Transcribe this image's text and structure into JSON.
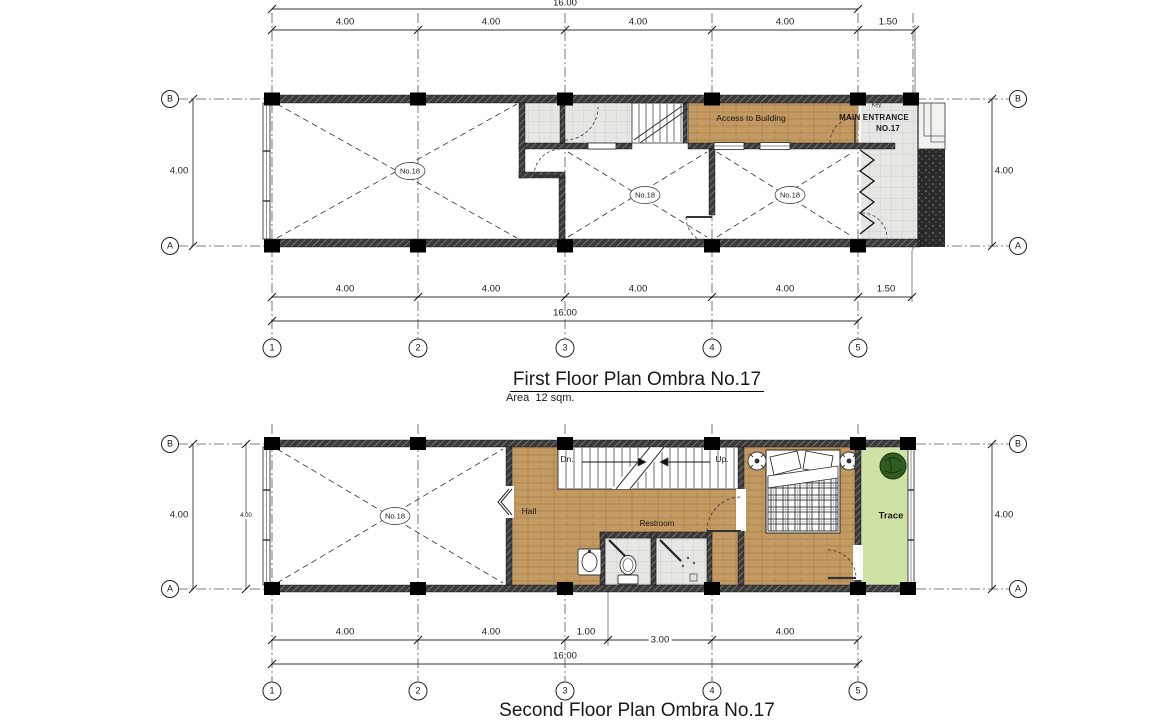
{
  "sheet": {
    "grid": {
      "row_labels": [
        "B",
        "A"
      ],
      "col_labels": [
        "1",
        "2",
        "3",
        "4",
        "5"
      ]
    },
    "first_floor": {
      "title": "First Floor Plan Ombra No.17",
      "area_note": "Area  12 sqm.",
      "dims": {
        "overall": "16.00",
        "top": [
          "4.00",
          "4.00",
          "4.00",
          "4.00",
          "1.50"
        ],
        "bottom": [
          "4.00",
          "4.00",
          "4.00",
          "4.00",
          "1.50"
        ],
        "left": "4.00",
        "right": "4.00"
      },
      "rooms": [
        "No.18",
        "No.18",
        "No.18"
      ],
      "labels": {
        "access": "Access to Building",
        "main_entrance": "MAIN ENTRANCE",
        "entrance_no": "NO.17",
        "key": "Key."
      }
    },
    "second_floor": {
      "title": "Second Floor Plan Ombra No.17",
      "dims": {
        "overall": "16.00",
        "bottom": [
          "4.00",
          "4.00",
          "1.00",
          "3.00",
          "4.00"
        ],
        "left": "4.00",
        "left_inner": "4.00",
        "right": "4.00"
      },
      "rooms": [
        "No.18"
      ],
      "labels": {
        "down": "Dn.",
        "up": "Up.",
        "hall": "Hall",
        "restroom": "Restroom",
        "terrace": "Trace"
      }
    },
    "colors": {
      "wood": "#c49a63",
      "wood_line": "#a67e48",
      "tile": "#e6e6e2",
      "terrace_green": "#cfe2a5",
      "plant_green": "#2f5d1f",
      "wall_dark": "#3b3b3b"
    }
  }
}
